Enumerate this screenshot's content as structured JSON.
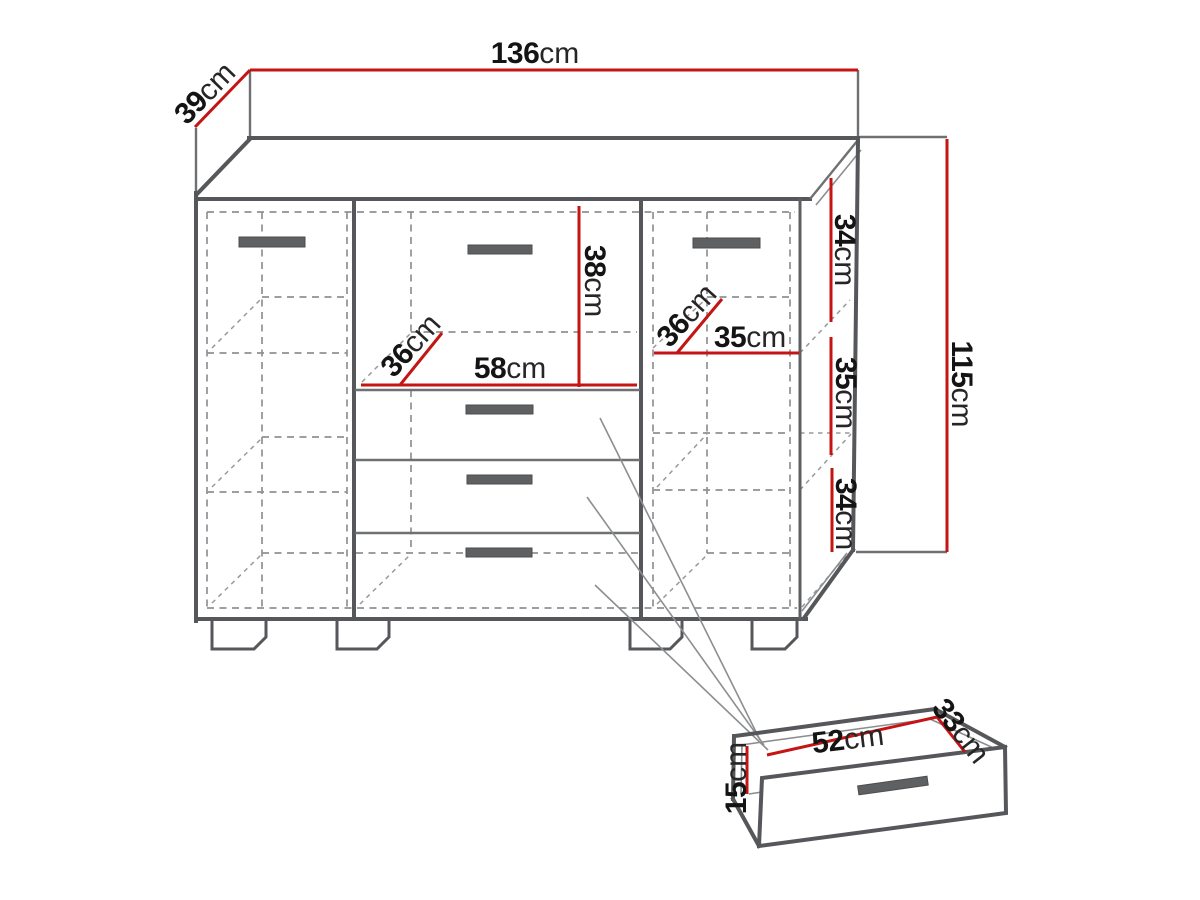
{
  "diagram": {
    "unit": "cm",
    "labels": {
      "width": "136",
      "depth": "39",
      "height": "115",
      "side_top": "34",
      "side_middle": "35",
      "side_bottom": "34",
      "top_drawer_height": "38",
      "center_depth": "36",
      "center_width": "58",
      "right_depth": "36",
      "right_width": "35",
      "drawer_width": "52",
      "drawer_depth": "33",
      "drawer_height": "15"
    },
    "colors": {
      "dimension_line": "#c41414",
      "outline": "#55575a",
      "hidden_line": "#8f9193",
      "handle": "#5e6062",
      "background": "#ffffff"
    }
  }
}
